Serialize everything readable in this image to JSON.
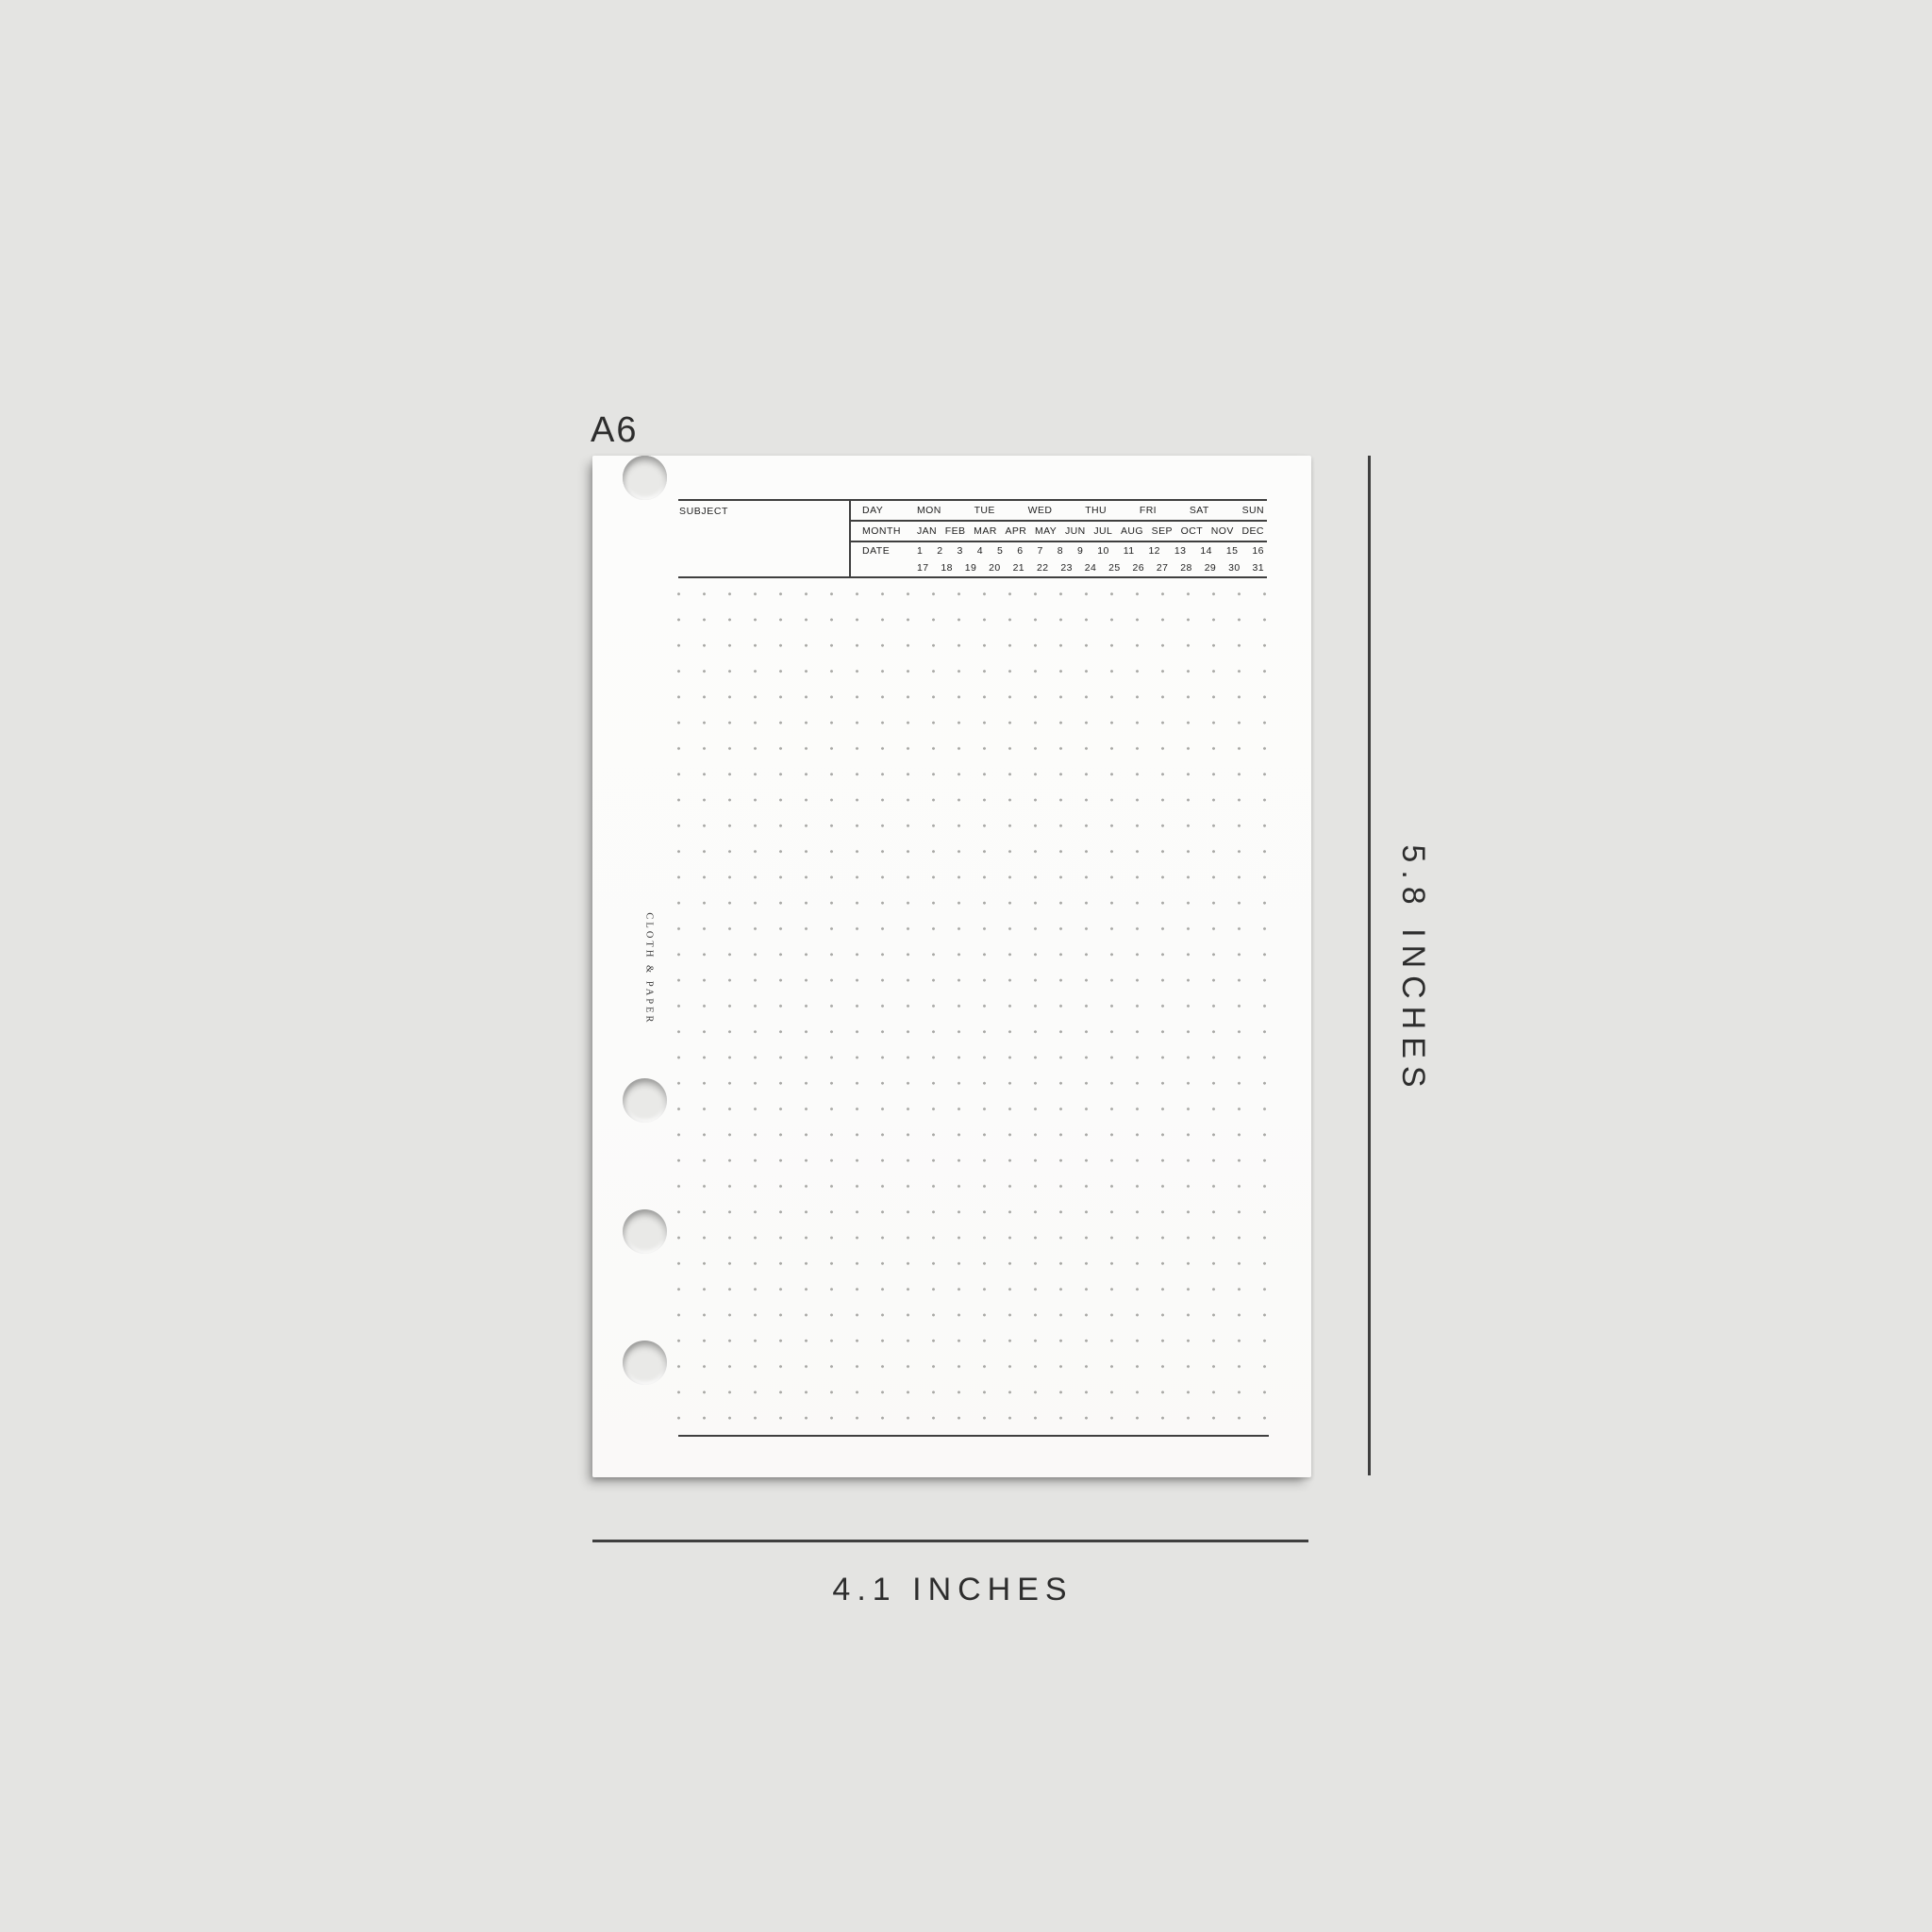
{
  "size_label": "A6",
  "brand": "CLOTH & PAPER",
  "dimensions": {
    "height_label": "5.8 INCHES",
    "width_label": "4.1 INCHES"
  },
  "header": {
    "subject_label": "SUBJECT",
    "day_label": "DAY",
    "month_label": "MONTH",
    "date_label": "DATE",
    "days": [
      "MON",
      "TUE",
      "WED",
      "THU",
      "FRI",
      "SAT",
      "SUN"
    ],
    "months": [
      "JAN",
      "FEB",
      "MAR",
      "APR",
      "MAY",
      "JUN",
      "JUL",
      "AUG",
      "SEP",
      "OCT",
      "NOV",
      "DEC"
    ],
    "dates_row1": [
      "1",
      "2",
      "3",
      "4",
      "5",
      "6",
      "7",
      "8",
      "9",
      "10",
      "11",
      "12",
      "13",
      "14",
      "15",
      "16"
    ],
    "dates_row2": [
      "17",
      "18",
      "19",
      "20",
      "21",
      "22",
      "23",
      "24",
      "25",
      "26",
      "27",
      "28",
      "29",
      "30",
      "31"
    ]
  },
  "colors": {
    "bg": "#e4e4e2",
    "paper": "#fbfbfa",
    "line": "#3f3f3f",
    "dot": "#a9a9a6",
    "ink": "#1f1f1f",
    "dim": "#2d2d2d"
  }
}
